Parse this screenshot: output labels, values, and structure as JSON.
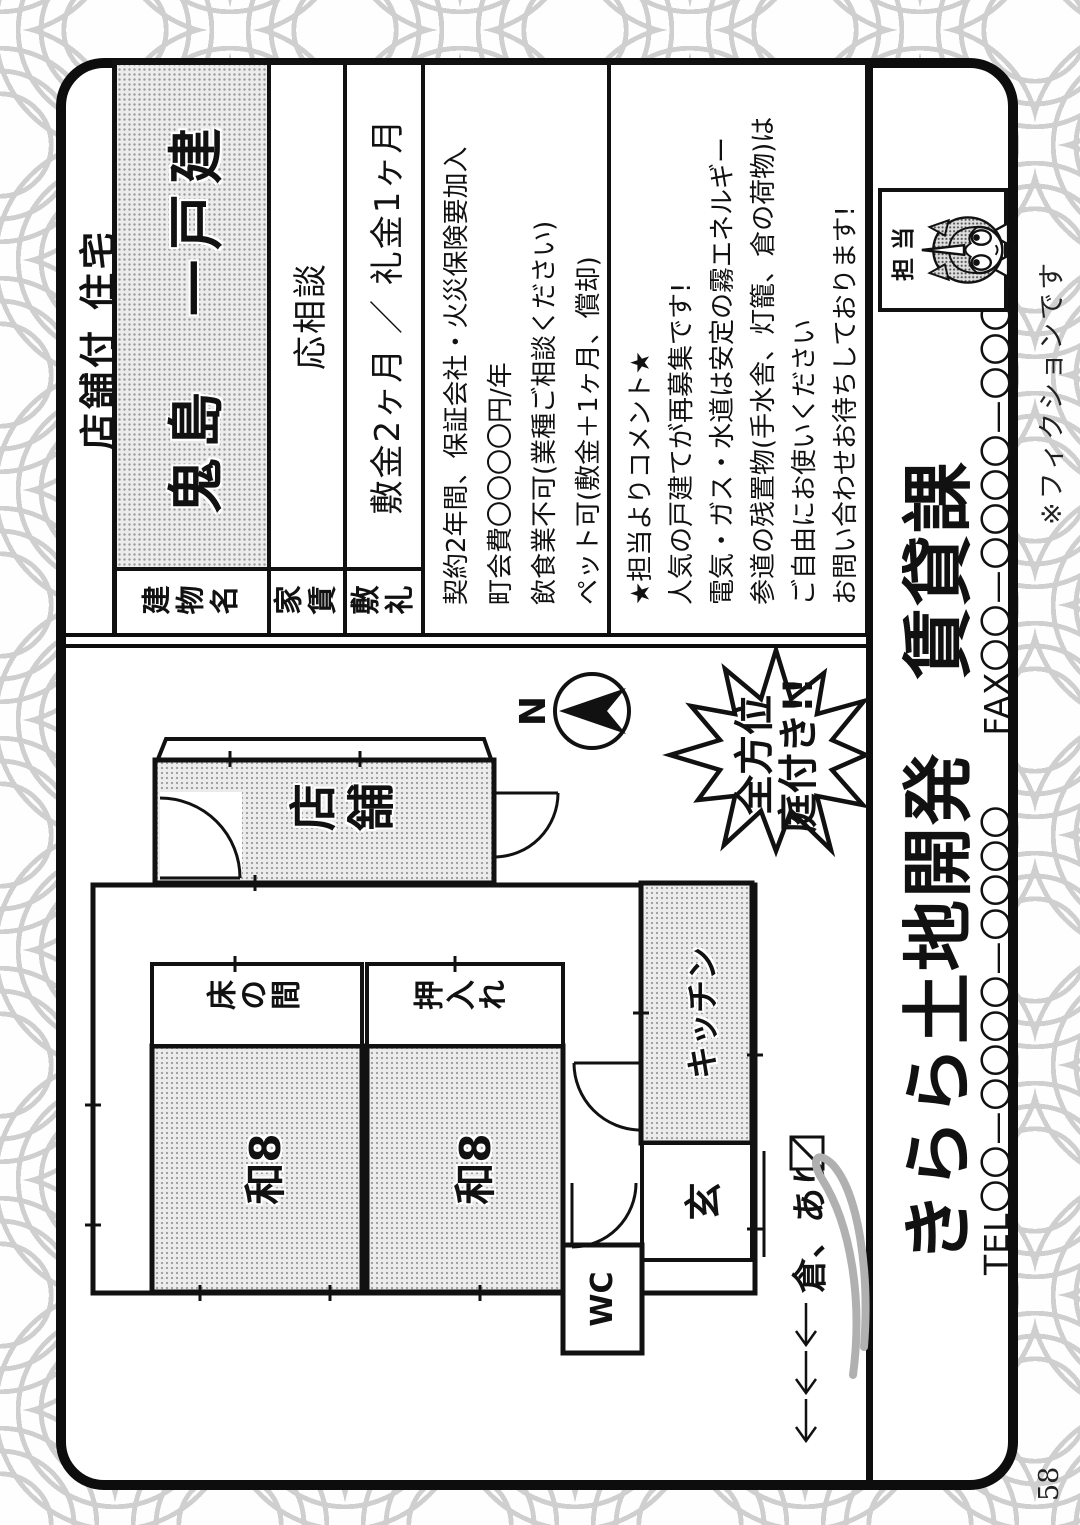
{
  "page": {
    "number": "58",
    "fiction_note": "※フィクションです"
  },
  "listing": {
    "category": "店舗付 住宅",
    "table": {
      "rows": [
        {
          "label": "建物名",
          "value": "鬼島　一戸建"
        },
        {
          "label": "家賃",
          "value": "応相談"
        },
        {
          "label": "敷礼",
          "value": "敷金2ヶ月 ／ 礼金1ヶ月"
        }
      ],
      "conditions": [
        "契約2年間、保証会社・火災保険要加入",
        "町会費〇〇〇〇円/年",
        "飲食業不可(業種ご相談ください)",
        "ペット可(敷金＋1ヶ月、償却)"
      ],
      "comment": [
        "★担当よりコメント★",
        "人気の戸建てが再募集です!",
        "電気・ガス・水道は安定の霧エネルギー",
        "参道の残置物(手水舎、灯籠、倉の荷物)は",
        "ご自由にお使いください",
        "お問い合わせお待ちしております!"
      ]
    },
    "floorplan": {
      "compass_label": "N",
      "burst_line1": "全方位",
      "burst_line2": "庭付き!!",
      "rooms": {
        "store": "店舗",
        "tokonoma": "床の間",
        "closet": "押入れ",
        "japanese_room": "和8",
        "kitchen": "キッチン",
        "entrance": "玄",
        "toilet": "WC"
      },
      "storage_note": "倉、あり"
    },
    "agency": {
      "name": "きらら土地開発　賃貸課",
      "tel": "TEL〇〇—〇〇〇〇—〇〇〇〇",
      "fax": "FAX〇〇—〇〇〇〇—〇〇〇〇",
      "staff_label": "担当"
    }
  }
}
